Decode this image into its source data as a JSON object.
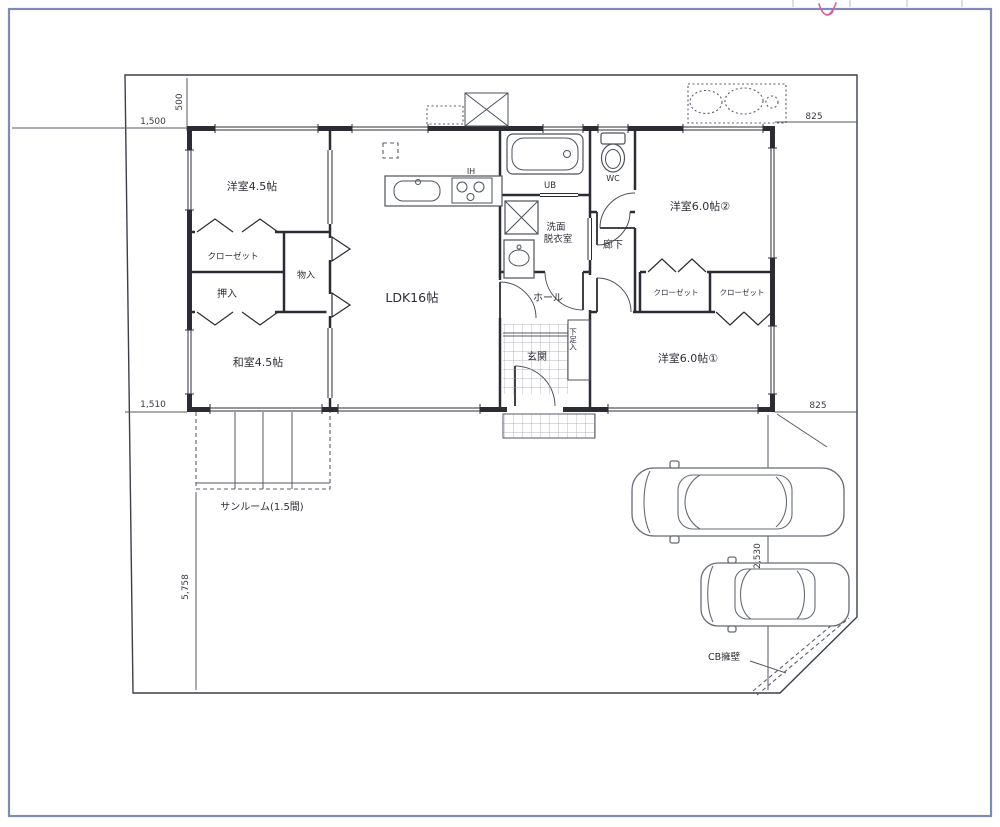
{
  "plan": {
    "rooms": {
      "western1": "洋室4.5帖",
      "closet_w1": "クローゼット",
      "oshiire": "押入",
      "monoire": "物入",
      "japanese": "和室4.5帖",
      "sunroom": "サンルーム(1.5間)",
      "ldk": "LDK16帖",
      "hall": "ホール",
      "corridor": "廊下",
      "entrance": "玄関",
      "shoe_storage": "下足入",
      "washroom_line1": "洗面",
      "washroom_line2": "脱衣室",
      "western2": "洋室6.0帖②",
      "closet_w2a": "クローゼット",
      "closet_w2b": "クローゼット",
      "western3": "洋室6.0帖①"
    },
    "fixtures": {
      "ih": "IH",
      "bath": "UB",
      "toilet": "WC"
    },
    "dimensions": {
      "offset_500": "500",
      "setback_1500": "1,500",
      "setback_1510": "1,510",
      "right_top_825": "825",
      "right_bottom_825": "825",
      "parking_2530": "2,530",
      "south_5758": "5,758"
    },
    "annotations": {
      "retaining_wall": "CB擁壁"
    },
    "colors": {
      "wall": "#2c2c34",
      "site_line": "#3a3f49",
      "page_frame": "#7d8bb6",
      "pink_mark": "#d85f9a"
    }
  }
}
